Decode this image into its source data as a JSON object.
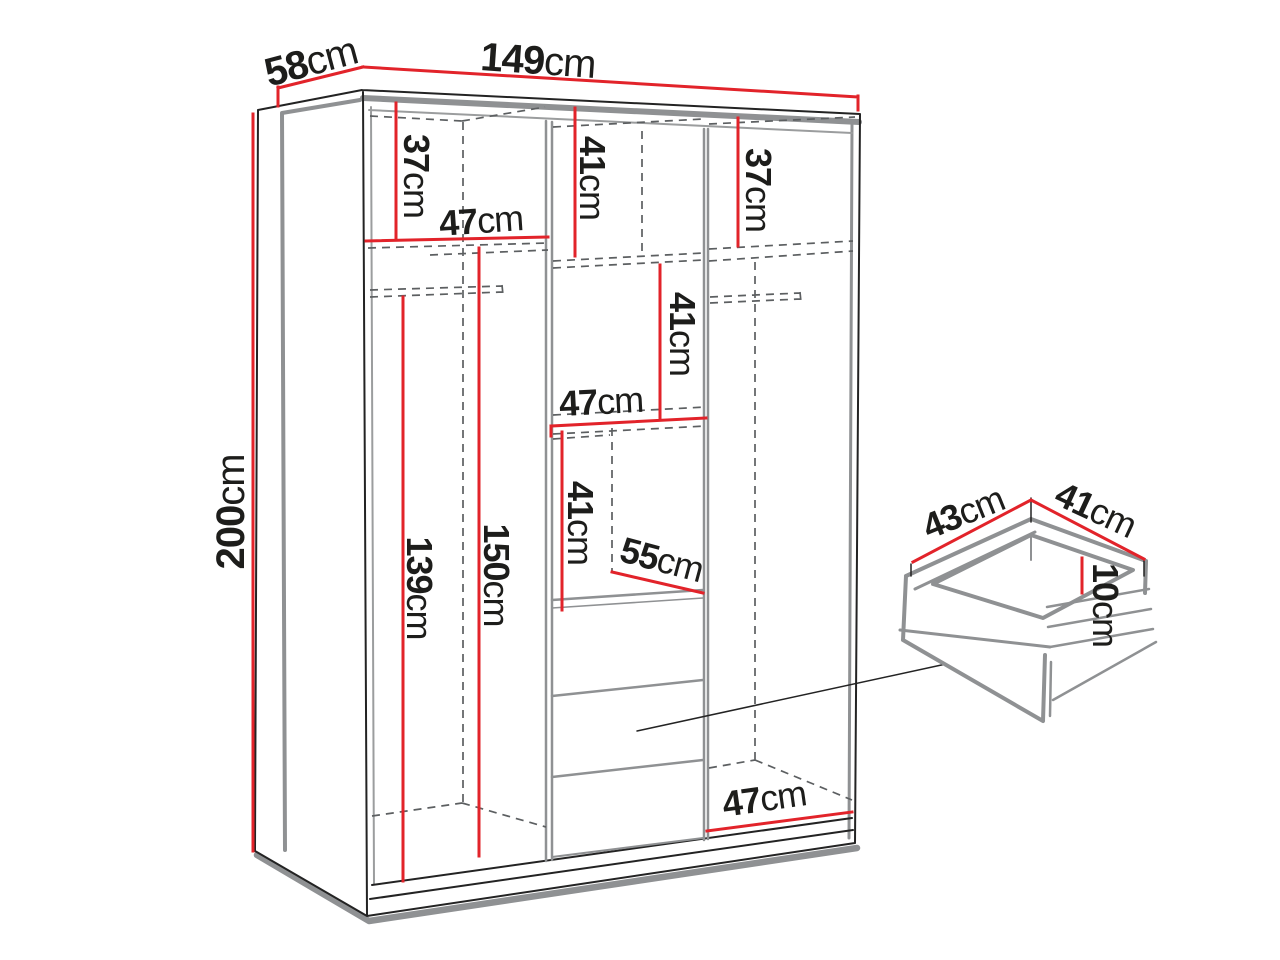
{
  "diagram": {
    "type": "furniture-dimension-diagram",
    "subject": "wardrobe interior dimensions with pull-out drawer detail"
  },
  "colors": {
    "dimension_line": "#e2232a",
    "outline_thick": "#8f9193",
    "outline_thin": "#232323",
    "hidden_line": "#5c5f61",
    "ceiling_line": "#9b9d9e",
    "label_text": "#1d1d1b",
    "background": "#ffffff"
  },
  "dimensions": {
    "overall": {
      "depth": {
        "value": "58",
        "unit": "cm"
      },
      "width": {
        "value": "149",
        "unit": "cm"
      },
      "height": {
        "value": "200",
        "unit": "cm"
      }
    },
    "interior": {
      "left_top_shelf_height": {
        "value": "37",
        "unit": "cm"
      },
      "left_section_width": {
        "value": "47",
        "unit": "cm"
      },
      "middle_top_shelf_height": {
        "value": "41",
        "unit": "cm"
      },
      "right_top_shelf_height": {
        "value": "37",
        "unit": "cm"
      },
      "middle_upper_cubby_height": {
        "value": "41",
        "unit": "cm"
      },
      "middle_section_width": {
        "value": "47",
        "unit": "cm"
      },
      "middle_lower_cubby_height": {
        "value": "41",
        "unit": "cm"
      },
      "middle_cubby_depth": {
        "value": "55",
        "unit": "cm"
      },
      "left_hanging_height": {
        "value": "139",
        "unit": "cm"
      },
      "left_interior_height": {
        "value": "150",
        "unit": "cm"
      },
      "right_section_width": {
        "value": "47",
        "unit": "cm"
      }
    },
    "drawer": {
      "depth": {
        "value": "43",
        "unit": "cm"
      },
      "width": {
        "value": "41",
        "unit": "cm"
      },
      "height": {
        "value": "10",
        "unit": "cm"
      }
    }
  }
}
